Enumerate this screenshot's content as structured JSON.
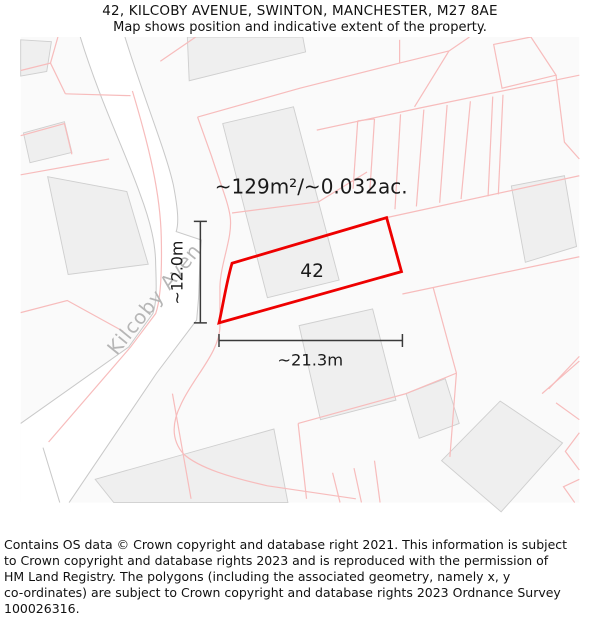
{
  "header": {
    "title": "42, KILCOBY AVENUE, SWINTON, MANCHESTER, M27 8AE",
    "subtitle": "Map shows position and indicative extent of the property."
  },
  "map": {
    "area_label": "~129m²/~0.032ac.",
    "plot_number": "42",
    "street_label": "Kilcoby Aven",
    "dim_vertical_label": "~12.0m",
    "dim_horizontal_label": "~21.3m",
    "colors": {
      "plot_outline": "#ee0000",
      "parcel_line": "#f7bcbc",
      "road_line": "#c9c9c9",
      "building_fill": "#efefef",
      "street_text": "#b6b6b6",
      "dimension_line": "#3a3a3a"
    }
  },
  "footer": {
    "lines": [
      "Contains OS data © Crown copyright and database right 2021. This information is subject",
      "to Crown copyright and database rights 2023 and is reproduced with the permission of",
      "HM Land Registry. The polygons (including the associated geometry, namely x, y",
      "co-ordinates) are subject to Crown copyright and database rights 2023 Ordnance Survey",
      "100026316."
    ]
  }
}
